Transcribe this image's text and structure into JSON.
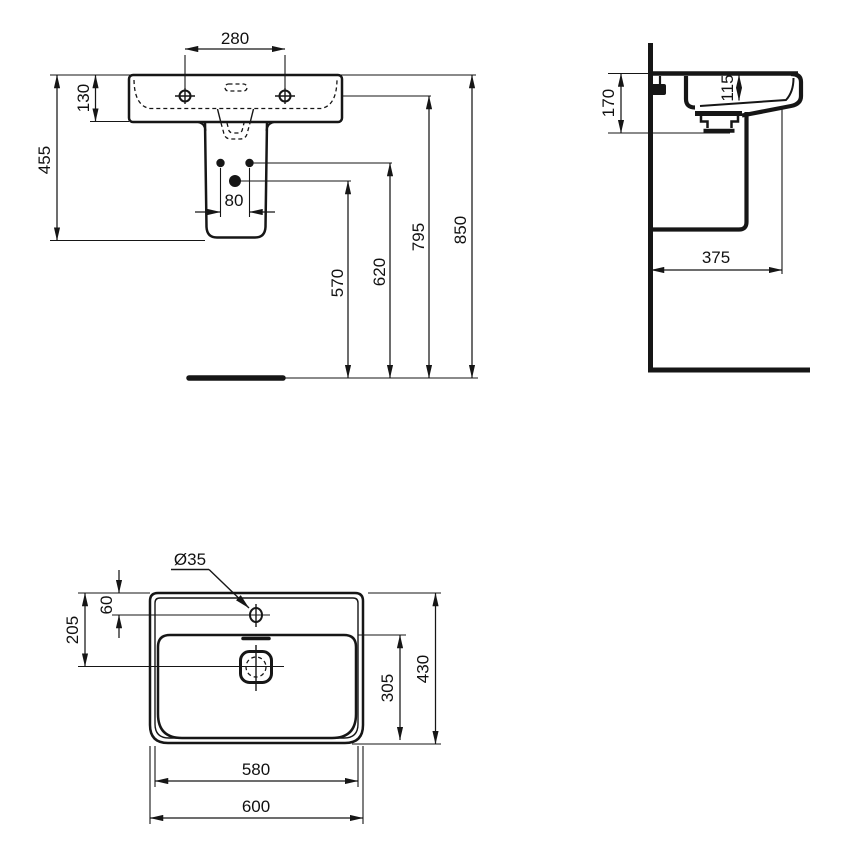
{
  "drawing": {
    "kind": "washbasin-with-semi-pedestal-dimension-drawing",
    "line_color": "#161616",
    "background": "#ffffff"
  },
  "front": {
    "d280": "280",
    "d130": "130",
    "d455": "455",
    "d80": "80",
    "d570": "570",
    "d620": "620",
    "d795": "795",
    "d850": "850"
  },
  "side": {
    "d170": "170",
    "d115": "115",
    "d375": "375"
  },
  "plan": {
    "d35": "Ø35",
    "d60": "60",
    "d205": "205",
    "d305": "305",
    "d430": "430",
    "d580": "580",
    "d600": "600"
  }
}
